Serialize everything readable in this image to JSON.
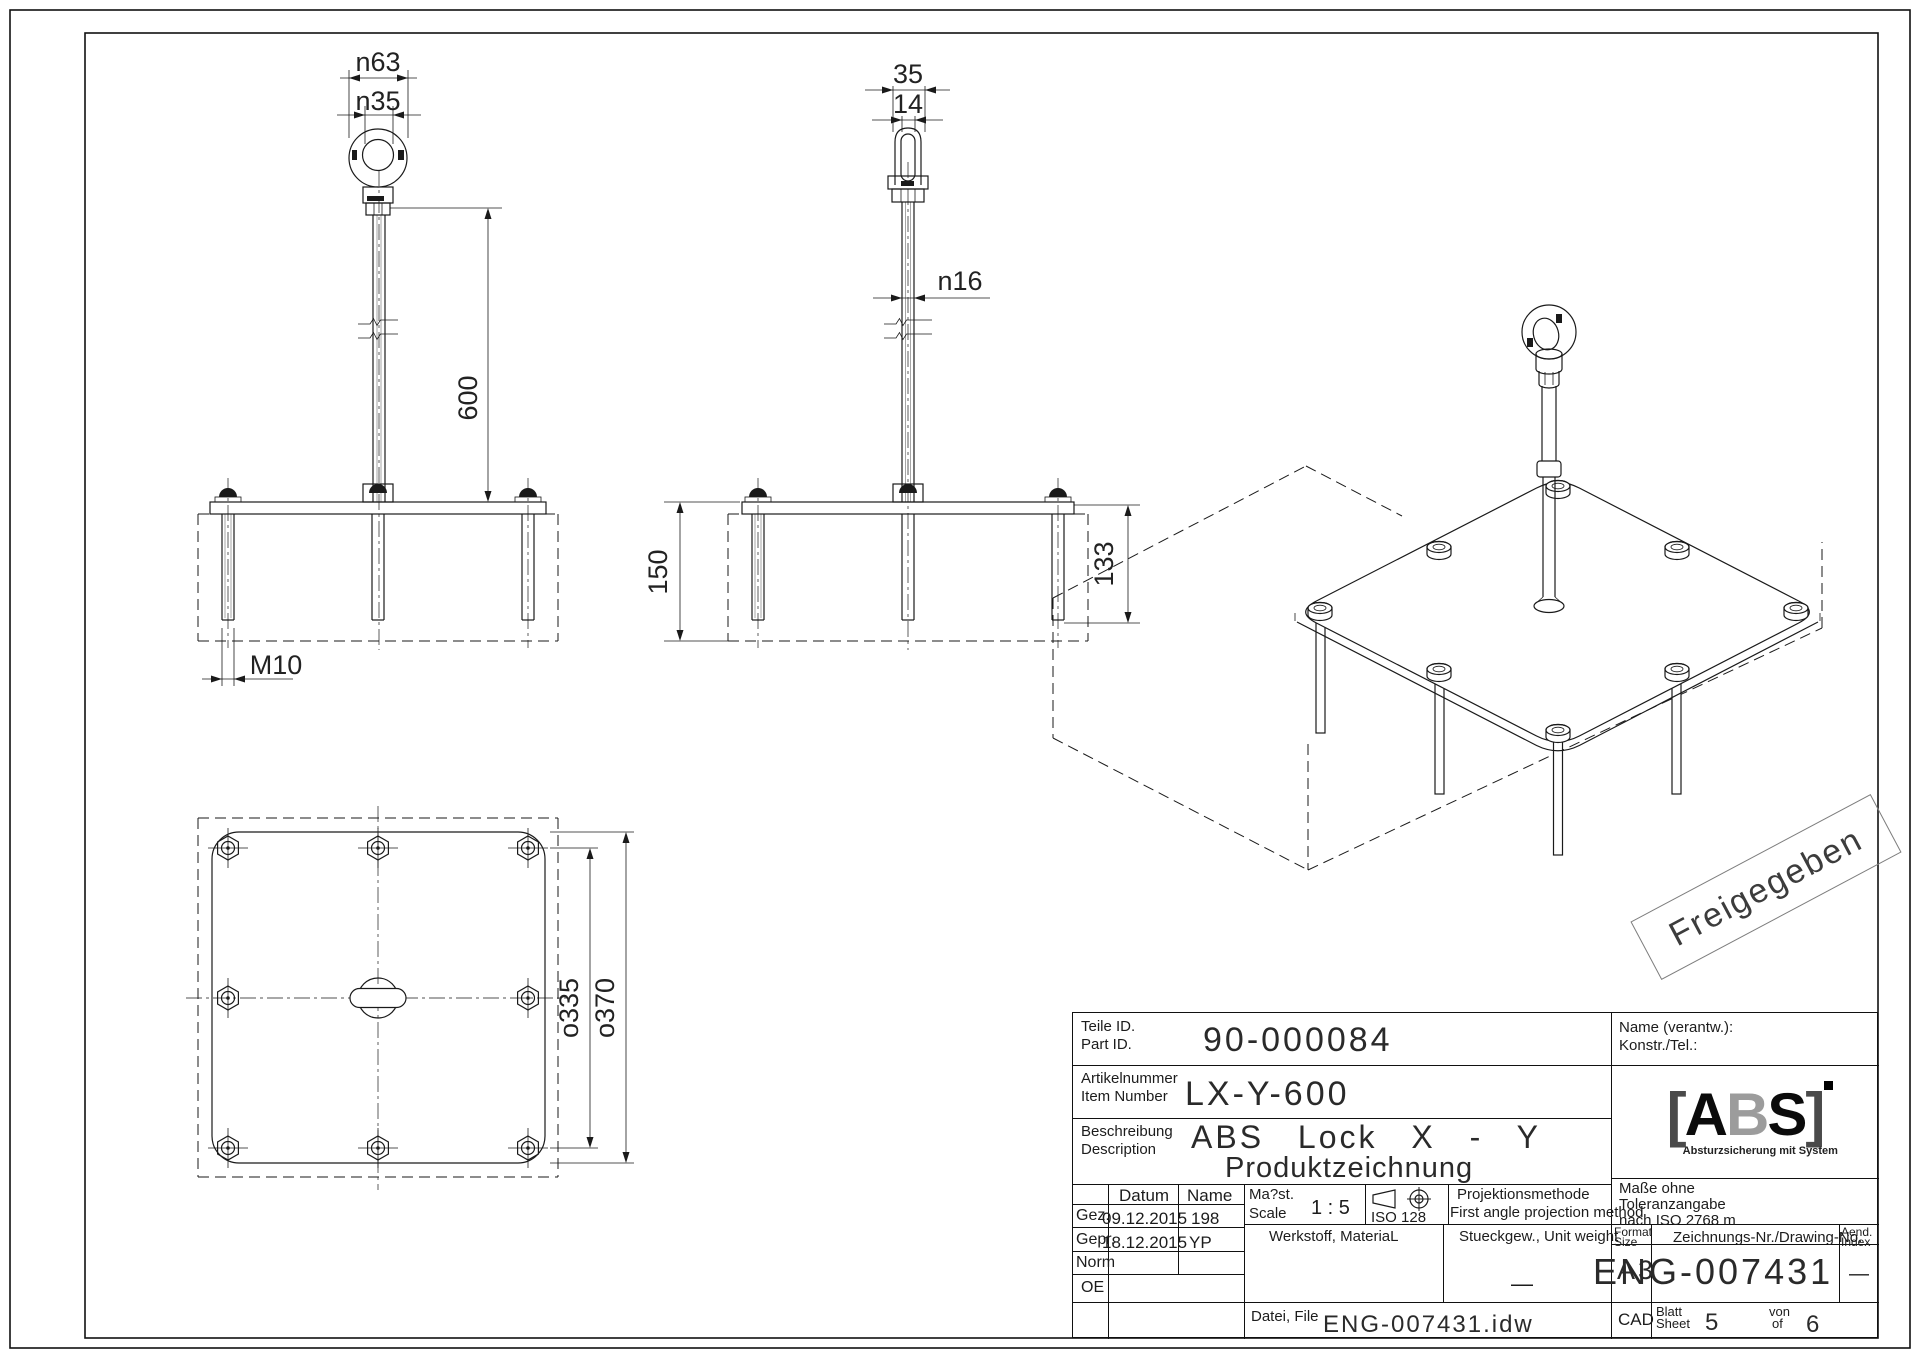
{
  "page": {
    "stamp": "Freigegeben"
  },
  "dims": {
    "front": {
      "outer_dia": "n63",
      "inner_dia": "n35",
      "rod_length": "600",
      "thread": "M10"
    },
    "side": {
      "eye_width": "35",
      "eye_thickness": "14",
      "rod_dia": "n16",
      "height_overall": "150",
      "stud_length": "133"
    },
    "plan": {
      "bolt_spacing": "o335",
      "plate_size": "o370"
    }
  },
  "title_block": {
    "part_id_label_de": "Teile ID.",
    "part_id_label_en": "Part ID.",
    "part_id": "90-000084",
    "item_label_de": "Artikelnummer",
    "item_label_en": "Item Number",
    "item_number": "LX-Y-600",
    "desc_label_de": "Beschreibung",
    "desc_label_en": "Description",
    "description_line1": "ABS Lock X - Y",
    "description_line2": "Produktzeichnung",
    "name_resp_label": "Name (verantw.):",
    "konstr_label": "Konstr./Tel.:",
    "col_datum": "Datum",
    "col_name": "Name",
    "sign_rows": [
      {
        "label": "Gez.",
        "date": "09.12.2015",
        "name": "198"
      },
      {
        "label": "Gepr.",
        "date": "18.12.2015",
        "name": "YP"
      },
      {
        "label": "Norm",
        "date": "",
        "name": ""
      },
      {
        "label": "OE",
        "date": "",
        "name": ""
      }
    ],
    "scale_label_de": "Ma?st.",
    "scale_label_en": "Scale",
    "scale_value": "1 : 5",
    "iso_label": "ISO 128",
    "projection_de": "Projektionsmethode",
    "projection_en": "First angle projection method",
    "material_label": "Werkstoff, MateriaL",
    "weight_label": "Stueckgew., Unit weight",
    "weight_value": "—",
    "tolerance_line1": "Maße ohne",
    "tolerance_line2": "Toleranzangabe",
    "tolerance_line3": "nach ISO 2768 m",
    "format_label_de": "Format",
    "format_label_en": "Size",
    "format_value": "A3",
    "drawing_no_label": "Zeichnungs-Nr./Drawing-No.",
    "drawing_no": "ENG-007431",
    "aend_label_de": "Aend.",
    "aend_label_en": "Index",
    "aend_value": "—",
    "cad_label": "CAD",
    "sheet_label_de": "Blatt",
    "sheet_label_en": "Sheet",
    "sheet_value": "5",
    "of_label_de": "von",
    "of_label_en": "of",
    "of_value": "6",
    "file_label": "Datei, File",
    "file_value": "ENG-007431.idw",
    "logo_bracket_l": "[",
    "logo_a": "A",
    "logo_b": "B",
    "logo_s": "S",
    "logo_bracket_r": "]",
    "logo_tagline": "Absturzsicherung mit System"
  }
}
